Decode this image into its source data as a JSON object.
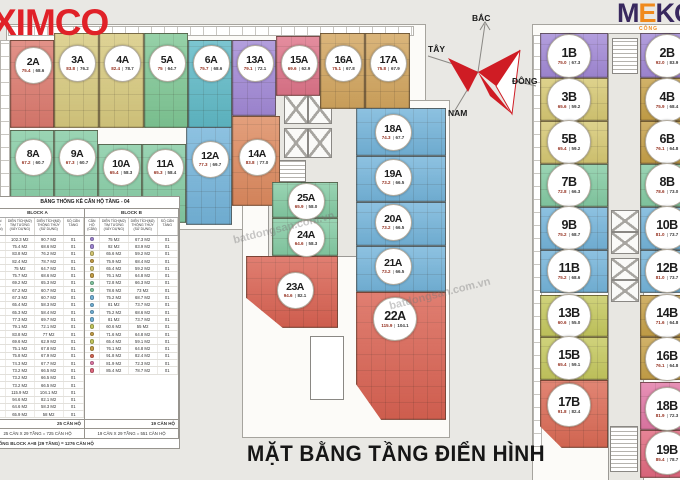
{
  "branding": {
    "ximco": "XIMCO",
    "meko_m": "M",
    "meko_e": "E",
    "meko_ko": "KO",
    "meko_sub": "CÔNG"
  },
  "compass": {
    "north": "BẮC",
    "south": "NAM",
    "east": "ĐÔNG",
    "west": "TÂY"
  },
  "title": "MẶT BẰNG TẦNG ĐIỂN HÌNH",
  "watermark": "batdongsan.com.vn",
  "blocks": [
    {
      "name": "A",
      "units": [
        {
          "id": "2A",
          "gross": "75.4",
          "net": "68.6",
          "color": "#dc7a6e",
          "x": 10,
          "y": 40,
          "w": 44,
          "h": 88,
          "by": 64
        },
        {
          "id": "3A",
          "gross": "83.8",
          "net": "76.2",
          "color": "#d7c97e",
          "x": 54,
          "y": 33,
          "w": 45,
          "h": 95,
          "by": 62
        },
        {
          "id": "4A",
          "gross": "82.4",
          "net": "78.7",
          "color": "#d7c97e",
          "x": 99,
          "y": 33,
          "w": 45,
          "h": 95,
          "by": 62
        },
        {
          "id": "5A",
          "gross": "75",
          "net": "64.7",
          "color": "#7fc795",
          "x": 144,
          "y": 33,
          "w": 44,
          "h": 95,
          "by": 62
        },
        {
          "id": "6A",
          "gross": "75.7",
          "net": "68.6",
          "color": "#5fb9c6",
          "x": 188,
          "y": 40,
          "w": 44,
          "h": 88,
          "by": 62
        },
        {
          "id": "13A",
          "gross": "79.1",
          "net": "72.1",
          "color": "#a289d6",
          "x": 232,
          "y": 40,
          "w": 44,
          "h": 76,
          "by": 62
        },
        {
          "id": "15A",
          "gross": "69.6",
          "net": "62.9",
          "color": "#de7489",
          "x": 276,
          "y": 36,
          "w": 44,
          "h": 60,
          "by": 62
        },
        {
          "id": "16A",
          "gross": "75.1",
          "net": "67.8",
          "color": "#d2a55e",
          "x": 320,
          "y": 33,
          "w": 45,
          "h": 76,
          "by": 62
        },
        {
          "id": "17A",
          "gross": "75.8",
          "net": "67.9",
          "color": "#d2a55e",
          "x": 365,
          "y": 33,
          "w": 45,
          "h": 76,
          "by": 62
        },
        {
          "id": "8A",
          "gross": "67.2",
          "net": "60.7",
          "color": "#84cba3",
          "x": 10,
          "y": 130,
          "w": 44,
          "h": 93,
          "by": 156
        },
        {
          "id": "9A",
          "gross": "67.3",
          "net": "60.7",
          "color": "#84cba3",
          "x": 54,
          "y": 130,
          "w": 44,
          "h": 93,
          "by": 156
        },
        {
          "id": "10A",
          "gross": "65.4",
          "net": "58.3",
          "color": "#84cba3",
          "x": 98,
          "y": 144,
          "w": 44,
          "h": 79,
          "by": 166
        },
        {
          "id": "11A",
          "gross": "65.3",
          "net": "58.4",
          "color": "#84cba3",
          "x": 142,
          "y": 144,
          "w": 44,
          "h": 79,
          "by": 166
        },
        {
          "id": "12A",
          "gross": "77.3",
          "net": "69.7",
          "color": "#74b4da",
          "x": 186,
          "y": 127,
          "w": 46,
          "h": 98,
          "by": 158
        },
        {
          "id": "14A",
          "gross": "83.8",
          "net": "77.0",
          "color": "#dd8a5f",
          "x": 232,
          "y": 116,
          "w": 48,
          "h": 90,
          "by": 156
        },
        {
          "id": "18A",
          "gross": "74.3",
          "net": "67.7",
          "color": "#74b4da",
          "x": 356,
          "y": 108,
          "w": 90,
          "h": 48,
          "bx": 392,
          "by": 131
        },
        {
          "id": "19A",
          "gross": "73.2",
          "net": "66.5",
          "color": "#74b4da",
          "x": 356,
          "y": 156,
          "w": 90,
          "h": 46,
          "bx": 392,
          "by": 176
        },
        {
          "id": "20A",
          "gross": "73.2",
          "net": "66.5",
          "color": "#74b4da",
          "x": 356,
          "y": 202,
          "w": 90,
          "h": 44,
          "bx": 392,
          "by": 221
        },
        {
          "id": "21A",
          "gross": "73.2",
          "net": "66.5",
          "color": "#74b4da",
          "x": 356,
          "y": 246,
          "w": 90,
          "h": 46,
          "bx": 392,
          "by": 265
        },
        {
          "id": "22A",
          "gross": "115.9",
          "net": "104.1",
          "color": "#d96252",
          "x": 356,
          "y": 292,
          "w": 90,
          "h": 128,
          "bx": 394,
          "by": 318,
          "big": true,
          "clip": "22"
        },
        {
          "id": "25A",
          "gross": "65.9",
          "net": "58.0",
          "color": "#84cba3",
          "x": 272,
          "y": 182,
          "w": 66,
          "h": 36,
          "by": 200
        },
        {
          "id": "24A",
          "gross": "64.6",
          "net": "58.3",
          "color": "#84cba3",
          "x": 272,
          "y": 218,
          "w": 66,
          "h": 38,
          "by": 237
        },
        {
          "id": "23A",
          "gross": "94.6",
          "net": "82.1",
          "color": "#d96252",
          "x": 246,
          "y": 256,
          "w": 92,
          "h": 72,
          "bx": 294,
          "by": 289,
          "clip": "23"
        }
      ]
    },
    {
      "name": "B",
      "units": [
        {
          "id": "1B",
          "gross": "75.0",
          "net": "67.3",
          "color": "#a289d6",
          "x": 540,
          "y": 33,
          "w": 68,
          "h": 45,
          "bx": 568,
          "by": 55
        },
        {
          "id": "2B",
          "gross": "92.0",
          "net": "83.9",
          "color": "#a289d6",
          "x": 640,
          "y": 33,
          "w": 42,
          "h": 45,
          "bx": 666,
          "by": 55
        },
        {
          "id": "3B",
          "gross": "65.6",
          "net": "59.2",
          "color": "#d6c873",
          "x": 540,
          "y": 78,
          "w": 68,
          "h": 43,
          "bx": 568,
          "by": 99
        },
        {
          "id": "4B",
          "gross": "75.9",
          "net": "68.4",
          "color": "#c7a148",
          "x": 640,
          "y": 78,
          "w": 42,
          "h": 43,
          "bx": 666,
          "by": 99
        },
        {
          "id": "5B",
          "gross": "65.4",
          "net": "59.2",
          "color": "#d6c873",
          "x": 540,
          "y": 121,
          "w": 68,
          "h": 43,
          "bx": 568,
          "by": 141
        },
        {
          "id": "6B",
          "gross": "76.1",
          "net": "64.8",
          "color": "#c7a148",
          "x": 640,
          "y": 121,
          "w": 42,
          "h": 43,
          "bx": 666,
          "by": 141
        },
        {
          "id": "7B",
          "gross": "72.8",
          "net": "66.3",
          "color": "#84cba3",
          "x": 540,
          "y": 164,
          "w": 68,
          "h": 43,
          "bx": 568,
          "by": 184
        },
        {
          "id": "8B",
          "gross": "78.6",
          "net": "73.0",
          "color": "#84cba3",
          "x": 640,
          "y": 164,
          "w": 42,
          "h": 43,
          "bx": 666,
          "by": 184
        },
        {
          "id": "9B",
          "gross": "75.2",
          "net": "68.7",
          "color": "#74b4da",
          "x": 540,
          "y": 207,
          "w": 68,
          "h": 43,
          "bx": 568,
          "by": 227
        },
        {
          "id": "10B",
          "gross": "81.0",
          "net": "73.7",
          "color": "#74b4da",
          "x": 640,
          "y": 207,
          "w": 42,
          "h": 43,
          "bx": 666,
          "by": 227
        },
        {
          "id": "11B",
          "gross": "75.2",
          "net": "68.6",
          "color": "#74b4da",
          "x": 540,
          "y": 250,
          "w": 68,
          "h": 43,
          "bx": 568,
          "by": 270
        },
        {
          "id": "12B",
          "gross": "81.0",
          "net": "73.7",
          "color": "#74b4da",
          "x": 640,
          "y": 250,
          "w": 42,
          "h": 43,
          "bx": 666,
          "by": 270
        },
        {
          "id": "13B",
          "gross": "60.6",
          "net": "55.0",
          "color": "#c5c85e",
          "x": 540,
          "y": 295,
          "w": 68,
          "h": 42,
          "bx": 568,
          "by": 315
        },
        {
          "id": "14B",
          "gross": "71.6",
          "net": "64.8",
          "color": "#c7a148",
          "x": 640,
          "y": 295,
          "w": 42,
          "h": 42,
          "bx": 666,
          "by": 315
        },
        {
          "id": "15B",
          "gross": "65.4",
          "net": "59.1",
          "color": "#c5c85e",
          "x": 540,
          "y": 337,
          "w": 68,
          "h": 43,
          "bx": 568,
          "by": 357
        },
        {
          "id": "16B",
          "gross": "76.1",
          "net": "64.8",
          "color": "#c7a148",
          "x": 640,
          "y": 337,
          "w": 42,
          "h": 43,
          "bx": 666,
          "by": 358
        },
        {
          "id": "17B",
          "gross": "91.8",
          "net": "82.4",
          "color": "#db6a55",
          "x": 540,
          "y": 380,
          "w": 68,
          "h": 68,
          "bx": 568,
          "by": 404,
          "clip": "17"
        },
        {
          "id": "18B",
          "gross": "81.9",
          "net": "72.3",
          "color": "#e279a6",
          "x": 640,
          "y": 382,
          "w": 42,
          "h": 48,
          "bx": 666,
          "by": 408
        },
        {
          "id": "19B",
          "gross": "85.4",
          "net": "78.7",
          "color": "#e2697f",
          "x": 640,
          "y": 430,
          "w": 42,
          "h": 48,
          "bx": 666,
          "by": 452
        }
      ]
    }
  ],
  "table": {
    "title": "BẢNG THỐNG KÊ CĂN HỘ TẦNG - 04",
    "extra_colors": {
      "1A": "#d96252",
      "7A": "#5fb9c6"
    },
    "sections": [
      {
        "block_label": "BLOCK A",
        "col_headers": [
          "CĂN HỘ (CĂN)",
          "DIỆN TÍCH(M2) TIM TƯỜNG (XÂY DỰNG)",
          "DIỆN TÍCH(M2) THÔNG THỦY (SỬ DỤNG)",
          "SỐ CĂN TẦNG"
        ],
        "rows": [
          [
            "1A",
            "102.3 M2",
            "90.7 M2",
            "01"
          ],
          [
            "2A",
            "75.4 M2",
            "68.6 M2",
            "01"
          ],
          [
            "3A",
            "83.8 M2",
            "76.2 M2",
            "01"
          ],
          [
            "4A",
            "82.4 M2",
            "78.7 M2",
            "01"
          ],
          [
            "5A",
            "75 M2",
            "64.7 M2",
            "01"
          ],
          [
            "6A",
            "75.7 M2",
            "68.6 M2",
            "01"
          ],
          [
            "7A",
            "69.2 M2",
            "65.3 M2",
            "01"
          ],
          [
            "8A",
            "67.2 M2",
            "60.7 M2",
            "01"
          ],
          [
            "9A",
            "67.3 M2",
            "60.7 M2",
            "01"
          ],
          [
            "10A",
            "65.4 M2",
            "58.3 M2",
            "01"
          ],
          [
            "11A",
            "65.3 M2",
            "58.4 M2",
            "01"
          ],
          [
            "12A",
            "77.3 M2",
            "69.7 M2",
            "01"
          ],
          [
            "13A",
            "79.1 M2",
            "72.1 M2",
            "01"
          ],
          [
            "14A",
            "83.8 M2",
            "77 M2",
            "01"
          ],
          [
            "15A",
            "69.6 M2",
            "62.9 M2",
            "01"
          ],
          [
            "16A",
            "75.1 M2",
            "67.8 M2",
            "01"
          ],
          [
            "17A",
            "75.8 M2",
            "67.9 M2",
            "01"
          ],
          [
            "18A",
            "74.3 M2",
            "67.7 M2",
            "01"
          ],
          [
            "19A",
            "73.2 M2",
            "66.5 M2",
            "01"
          ],
          [
            "20A",
            "73.2 M2",
            "66.5 M2",
            "01"
          ],
          [
            "21A",
            "73.2 M2",
            "66.5 M2",
            "01"
          ],
          [
            "22A",
            "115.9 M2",
            "104.1 M2",
            "01"
          ],
          [
            "23A",
            "94.6 M2",
            "82.1 M2",
            "01"
          ],
          [
            "24A",
            "64.6 M2",
            "58.3 M2",
            "01"
          ],
          [
            "25A",
            "65.9 M2",
            "58 M2",
            "01"
          ]
        ],
        "subtotal": "25 CĂN HỘ",
        "formula": "25 CĂN X 29 TẦNG = 725 CĂN HỘ"
      },
      {
        "block_label": "BLOCK B",
        "col_headers": [
          "CĂN HỘ (CĂN)",
          "DIỆN TÍCH(M2) TIM TƯỜNG (XÂY DỰNG)",
          "DIỆN TÍCH(M2) THÔNG THỦY (SỬ DỤNG)",
          "SỐ CĂN TẦNG"
        ],
        "rows": [
          [
            "1B",
            "75 M2",
            "67.3 M2",
            "01"
          ],
          [
            "2B",
            "92 M2",
            "83.9 M2",
            "01"
          ],
          [
            "3B",
            "65.6 M2",
            "59.2 M2",
            "01"
          ],
          [
            "4B",
            "75.9 M2",
            "68.4 M2",
            "01"
          ],
          [
            "5B",
            "65.4 M2",
            "59.2 M2",
            "01"
          ],
          [
            "6B",
            "76.1 M2",
            "64.8 M2",
            "01"
          ],
          [
            "7B",
            "72.8 M2",
            "66.3 M2",
            "01"
          ],
          [
            "8B",
            "78.6 M2",
            "73 M2",
            "01"
          ],
          [
            "9B",
            "75.2 M2",
            "68.7 M2",
            "01"
          ],
          [
            "10B",
            "81 M2",
            "73.7 M2",
            "01"
          ],
          [
            "11B",
            "75.2 M2",
            "68.6 M2",
            "01"
          ],
          [
            "12B",
            "81 M2",
            "73.7 M2",
            "01"
          ],
          [
            "13B",
            "60.6 M2",
            "55 M2",
            "01"
          ],
          [
            "14B",
            "71.6 M2",
            "64.8 M2",
            "01"
          ],
          [
            "15B",
            "65.4 M2",
            "59.1 M2",
            "01"
          ],
          [
            "16B",
            "76.1 M2",
            "64.8 M2",
            "01"
          ],
          [
            "17B",
            "91.8 M2",
            "82.4 M2",
            "01"
          ],
          [
            "18B",
            "81.9 M2",
            "72.3 M2",
            "01"
          ],
          [
            "19B",
            "85.4 M2",
            "78.7 M2",
            "01"
          ]
        ],
        "subtotal": "19 CĂN HỘ",
        "formula": "19 CĂN X 29 TẦNG = 551 CĂN HỘ"
      }
    ],
    "total": "TỔNG BLOCK A+B (29 TẦNG) = 1276 CĂN HỘ"
  }
}
